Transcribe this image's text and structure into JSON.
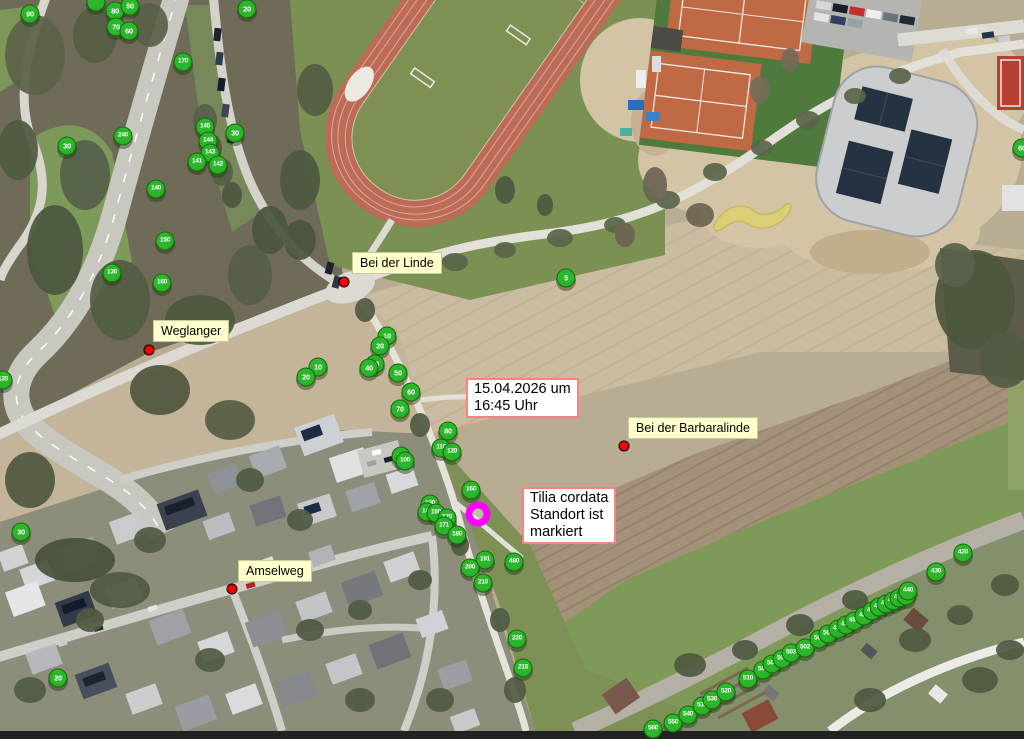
{
  "colors": {
    "marker_fill": "#2db52d",
    "marker_fill_dark": "#1f9a1f",
    "marker_edge": "#156b00",
    "poi_red": "#f40000",
    "label_bg": "#ffffcc",
    "note_border": "#ff8080",
    "highlight": "#ff00ff"
  },
  "notes": [
    {
      "x": 466,
      "y": 378,
      "lines": [
        "15.04.2026 um",
        "16:45 Uhr"
      ]
    },
    {
      "x": 522,
      "y": 487,
      "lines": [
        "Tilia cordata",
        "Standort ist",
        "markiert"
      ]
    }
  ],
  "poi_labels": [
    {
      "label": "Bei der Linde",
      "box": {
        "x": 352,
        "y": 252
      },
      "dot": {
        "x": 344,
        "y": 282
      }
    },
    {
      "label": "Weglanger",
      "box": {
        "x": 153,
        "y": 320
      },
      "dot": {
        "x": 149,
        "y": 350
      }
    },
    {
      "label": "Amselweg",
      "box": {
        "x": 238,
        "y": 560
      },
      "dot": {
        "x": 232,
        "y": 589
      }
    },
    {
      "label": "Bei der Barbaralinde",
      "box": {
        "x": 628,
        "y": 417
      },
      "dot": {
        "x": 624,
        "y": 446
      }
    }
  ],
  "selected_tree": {
    "x": 478,
    "y": 514
  },
  "tree_markers": [
    {
      "n": "90",
      "x": 30,
      "y": 14
    },
    {
      "n": "",
      "x": 96,
      "y": 2
    },
    {
      "n": "80",
      "x": 115,
      "y": 11
    },
    {
      "n": "50",
      "x": 130,
      "y": 6
    },
    {
      "n": "70",
      "x": 116,
      "y": 27
    },
    {
      "n": "60",
      "x": 129,
      "y": 31
    },
    {
      "n": "20",
      "x": 247,
      "y": 9
    },
    {
      "n": "170",
      "x": 183,
      "y": 62
    },
    {
      "n": "240",
      "x": 123,
      "y": 136
    },
    {
      "n": "30",
      "x": 67,
      "y": 146
    },
    {
      "n": "145",
      "x": 205,
      "y": 127
    },
    {
      "n": "144",
      "x": 208,
      "y": 141
    },
    {
      "n": "143",
      "x": 210,
      "y": 153
    },
    {
      "n": "141",
      "x": 197,
      "y": 162
    },
    {
      "n": "142",
      "x": 218,
      "y": 165
    },
    {
      "n": "30",
      "x": 235,
      "y": 133
    },
    {
      "n": "140",
      "x": 156,
      "y": 189
    },
    {
      "n": "150",
      "x": 165,
      "y": 241
    },
    {
      "n": "130",
      "x": 112,
      "y": 273
    },
    {
      "n": "160",
      "x": 162,
      "y": 283
    },
    {
      "n": "120",
      "x": 3,
      "y": 380
    },
    {
      "n": "30",
      "x": 21,
      "y": 532
    },
    {
      "n": "20",
      "x": 58,
      "y": 678
    },
    {
      "n": "5",
      "x": 566,
      "y": 278
    },
    {
      "n": "10",
      "x": 318,
      "y": 367
    },
    {
      "n": "20",
      "x": 306,
      "y": 377
    },
    {
      "n": "10",
      "x": 387,
      "y": 336
    },
    {
      "n": "20",
      "x": 380,
      "y": 346
    },
    {
      "n": "30",
      "x": 375,
      "y": 364
    },
    {
      "n": "40",
      "x": 369,
      "y": 368
    },
    {
      "n": "50",
      "x": 398,
      "y": 373
    },
    {
      "n": "60",
      "x": 411,
      "y": 392
    },
    {
      "n": "70",
      "x": 400,
      "y": 409
    },
    {
      "n": "80",
      "x": 448,
      "y": 431
    },
    {
      "n": "110",
      "x": 441,
      "y": 448
    },
    {
      "n": "120",
      "x": 452,
      "y": 452
    },
    {
      "n": "90",
      "x": 401,
      "y": 456
    },
    {
      "n": "100",
      "x": 405,
      "y": 461
    },
    {
      "n": "160",
      "x": 471,
      "y": 490
    },
    {
      "n": "130",
      "x": 430,
      "y": 504
    },
    {
      "n": "140",
      "x": 427,
      "y": 512
    },
    {
      "n": "150",
      "x": 436,
      "y": 513
    },
    {
      "n": "170",
      "x": 447,
      "y": 518
    },
    {
      "n": "171",
      "x": 444,
      "y": 526
    },
    {
      "n": "180",
      "x": 457,
      "y": 535
    },
    {
      "n": "191",
      "x": 485,
      "y": 560
    },
    {
      "n": "200",
      "x": 470,
      "y": 568
    },
    {
      "n": "480",
      "x": 514,
      "y": 562
    },
    {
      "n": "210",
      "x": 483,
      "y": 583
    },
    {
      "n": "220",
      "x": 517,
      "y": 639
    },
    {
      "n": "215",
      "x": 523,
      "y": 668
    },
    {
      "n": "560",
      "x": 653,
      "y": 729
    },
    {
      "n": "550",
      "x": 673,
      "y": 723
    },
    {
      "n": "540",
      "x": 688,
      "y": 715
    },
    {
      "n": "535",
      "x": 702,
      "y": 706
    },
    {
      "n": "530",
      "x": 712,
      "y": 700
    },
    {
      "n": "520",
      "x": 726,
      "y": 692
    },
    {
      "n": "510",
      "x": 748,
      "y": 679
    },
    {
      "n": "506",
      "x": 763,
      "y": 670
    },
    {
      "n": "505",
      "x": 772,
      "y": 664
    },
    {
      "n": "504",
      "x": 782,
      "y": 659
    },
    {
      "n": "503",
      "x": 791,
      "y": 653
    },
    {
      "n": "502",
      "x": 805,
      "y": 648
    },
    {
      "n": "500",
      "x": 819,
      "y": 639
    },
    {
      "n": "501",
      "x": 828,
      "y": 634
    },
    {
      "n": "496",
      "x": 838,
      "y": 629
    },
    {
      "n": "452",
      "x": 846,
      "y": 625
    },
    {
      "n": "490",
      "x": 854,
      "y": 621
    },
    {
      "n": "450",
      "x": 864,
      "y": 616
    },
    {
      "n": "455",
      "x": 872,
      "y": 611
    },
    {
      "n": "460",
      "x": 879,
      "y": 607
    },
    {
      "n": "470",
      "x": 886,
      "y": 604
    },
    {
      "n": "480",
      "x": 893,
      "y": 601
    },
    {
      "n": "410",
      "x": 899,
      "y": 598
    },
    {
      "n": "420",
      "x": 906,
      "y": 596
    },
    {
      "n": "440",
      "x": 908,
      "y": 591
    },
    {
      "n": "430",
      "x": 936,
      "y": 572
    },
    {
      "n": "420",
      "x": 963,
      "y": 553
    },
    {
      "n": "60",
      "x": 1022,
      "y": 148
    }
  ]
}
